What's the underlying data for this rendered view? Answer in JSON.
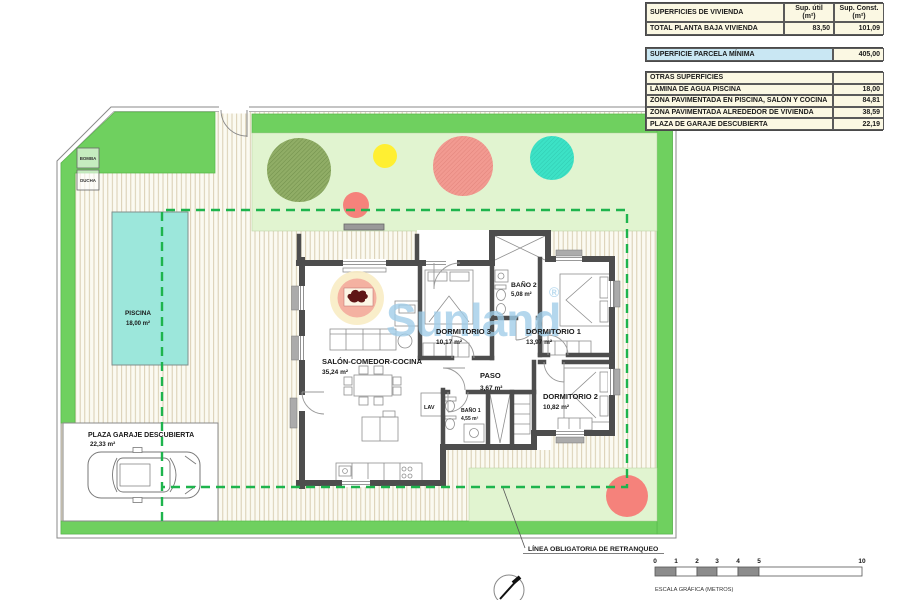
{
  "tables": {
    "viviendas": {
      "title": "SUPERFICIES DE VIVIENDA",
      "col_util": "Sup. útil",
      "col_const": "Sup. Const.",
      "unit": "(m²)",
      "rows": [
        {
          "label": "TOTAL PLANTA BAJA VIVIENDA",
          "util": "83,50",
          "const": "101,09"
        }
      ]
    },
    "parcela": {
      "label": "SUPERFICIE PARCELA MÍNIMA",
      "value": "405,00"
    },
    "otras": {
      "title": "OTRAS SUPERFICIES",
      "rows": [
        {
          "label": "LÁMINA DE AGUA PISCINA",
          "value": "18,00"
        },
        {
          "label": "ZONA PAVIMENTADA EN PISCINA, SALÓN Y COCINA",
          "value": "84,81"
        },
        {
          "label": "ZONA PAVIMENTADA ALREDEDOR DE VIVIENDA",
          "value": "38,59"
        },
        {
          "label": "PLAZA DE GARAJE DESCUBIERTA",
          "value": "22,19"
        }
      ]
    }
  },
  "plan": {
    "rooms": [
      {
        "name": "SALÓN-COMEDOR-COCINA",
        "area": "35,24 m²"
      },
      {
        "name": "DORMITORIO 3",
        "area": "10,17 m²"
      },
      {
        "name": "BAÑO 2",
        "area": "5,08 m²"
      },
      {
        "name": "DORMITORIO 1",
        "area": "13,97 m²"
      },
      {
        "name": "PASO",
        "area": "3,67 m²"
      },
      {
        "name": "BAÑO 1",
        "area": "4,55 m²"
      },
      {
        "name": "DORMITORIO 2",
        "area": "10,82 m²"
      },
      {
        "name": "LAV"
      }
    ],
    "outdoor": {
      "piscina": {
        "name": "PISCINA",
        "area": "18,00 m²"
      },
      "garaje": {
        "name": "PLAZA GARAJE DESCUBIERTA",
        "area": "22,33 m²"
      },
      "bomba": "BOMBA",
      "ducha": "DUCHA"
    },
    "annotations": {
      "retranqueo": "LÍNEA OBLIGATORIA DE RETRANQUEO",
      "escala": "ESCALA GRÁFICA (METROS)"
    },
    "scalebar": {
      "ticks": [
        "0",
        "1",
        "2",
        "3",
        "4",
        "5",
        "10"
      ]
    },
    "watermark": {
      "text": "Sunland",
      "registered": "®"
    },
    "colors": {
      "lawn_green": "#6fd05f",
      "pale_green": "#e1f4d0",
      "pool": "#9ce7db",
      "setback_dash": "#1eb44d",
      "tree_olive": "#90ad66",
      "tree_salmon": "#f29a91",
      "tree_teal": "#3ce2c6",
      "tree_yellow": "#ffef32",
      "watermark_blue": "#9fcde9",
      "table_cream": "#fbf8e3",
      "table_blue": "#c9e7f3",
      "wall": "#4d4d4d"
    }
  }
}
